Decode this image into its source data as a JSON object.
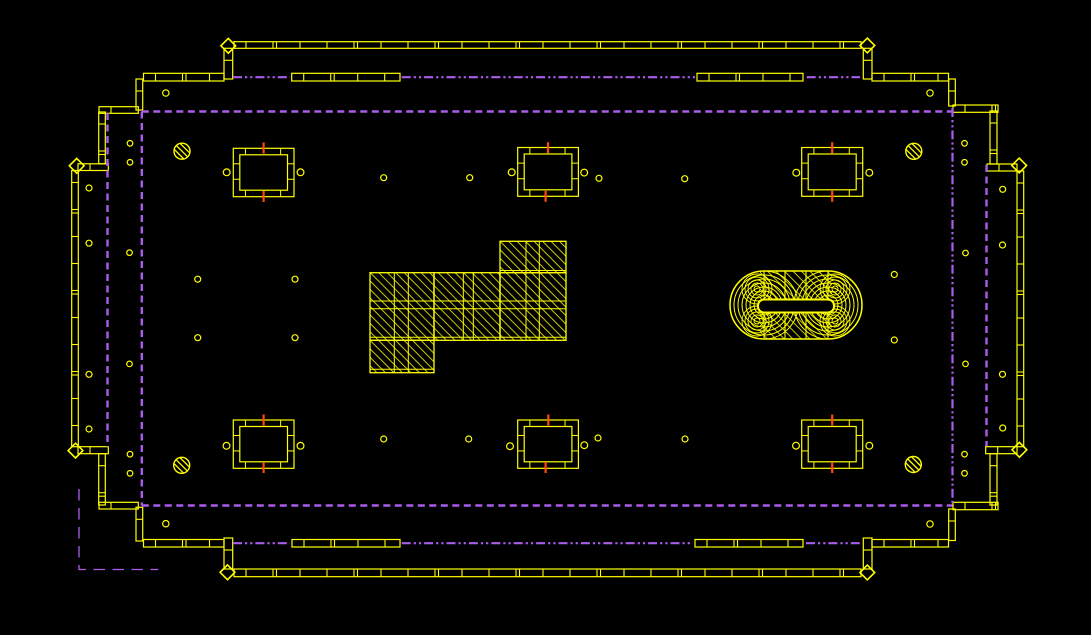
{
  "canvas": {
    "width": 1091,
    "height": 635,
    "background": "#000000"
  },
  "drawing_type": "cad-foundation-floor-plan",
  "colors": {
    "wall": "#ffff00",
    "boundary": "#aa5cec",
    "marker": "#ff4a00",
    "background": "#000000"
  },
  "line_styles": {
    "dash": {
      "width": 2.4,
      "dasharray": [
        7,
        4.5
      ]
    },
    "dashdot": {
      "width": 2.2,
      "dasharray": [
        9,
        3,
        2.2,
        3,
        2.2,
        3
      ]
    },
    "longdash": {
      "width": 1.3,
      "dasharray": [
        11.5,
        7.5
      ]
    }
  },
  "walls": [
    {
      "n": "top-outer-wall",
      "r": [
        234,
        41.7,
        627,
        6.6
      ]
    },
    {
      "n": "top-inner-wall-left",
      "r": [
        143.5,
        73.3,
        80.5,
        7.7
      ]
    },
    {
      "n": "top-inner-wall-mid1",
      "r": [
        291.7,
        73.3,
        108.3,
        7.7
      ]
    },
    {
      "n": "top-inner-wall-mid2",
      "r": [
        697,
        73.3,
        106,
        7.7
      ]
    },
    {
      "n": "top-inner-wall-right",
      "r": [
        872,
        73.3,
        76.5,
        7.7
      ]
    },
    {
      "n": "step-wall-top-left",
      "r": [
        99,
        106.7,
        39.3,
        6.6
      ]
    },
    {
      "n": "step-wall-top-right",
      "r": [
        953,
        105,
        45,
        7.3
      ]
    },
    {
      "n": "cap-wall-top-left",
      "r": [
        78,
        163.8,
        30.3,
        6.7
      ]
    },
    {
      "n": "cap-wall-top-right",
      "r": [
        987,
        164,
        30,
        7
      ]
    },
    {
      "n": "cap-wall-bottom-left",
      "r": [
        78,
        446.7,
        30.3,
        7
      ]
    },
    {
      "n": "cap-wall-bottom-right",
      "r": [
        985.7,
        446.7,
        31.3,
        7
      ]
    },
    {
      "n": "step-wall-bottom-left",
      "r": [
        99,
        502.3,
        39.3,
        6.7
      ]
    },
    {
      "n": "step-wall-bottom-right",
      "r": [
        953,
        502.3,
        45,
        7.4
      ]
    },
    {
      "n": "bottom-inner-wall-left",
      "r": [
        143.5,
        539.5,
        80.5,
        7.5
      ]
    },
    {
      "n": "bottom-inner-wall-mid1",
      "r": [
        292,
        539.5,
        108,
        7.5
      ]
    },
    {
      "n": "bottom-inner-wall-mid2",
      "r": [
        695,
        539.5,
        108,
        7.5
      ]
    },
    {
      "n": "bottom-inner-wall-right",
      "r": [
        872,
        539.5,
        76.5,
        7.5
      ]
    },
    {
      "n": "bottom-outer-wall",
      "r": [
        234,
        569,
        627,
        7.7
      ]
    },
    {
      "n": "connector-top-left",
      "r": [
        224,
        48.3,
        8.7,
        30.7
      ]
    },
    {
      "n": "connector-top-right",
      "r": [
        863.3,
        48.3,
        8.7,
        30.7
      ]
    },
    {
      "n": "connector-bottom-left",
      "r": [
        224,
        538,
        8.7,
        31
      ]
    },
    {
      "n": "connector-bottom-right",
      "r": [
        863.3,
        538,
        8.7,
        31
      ]
    },
    {
      "n": "step-v1-top-left",
      "r": [
        136,
        79,
        6.7,
        31
      ]
    },
    {
      "n": "step-v2-top-left",
      "r": [
        98.7,
        112,
        6.6,
        51.8
      ]
    },
    {
      "n": "step-v1-top-right",
      "r": [
        948.7,
        79,
        6.6,
        27
      ]
    },
    {
      "n": "step-v2-top-right",
      "r": [
        990,
        111,
        7,
        53
      ]
    },
    {
      "n": "left-outer-wall",
      "r": [
        71.7,
        170.5,
        6.6,
        276.2
      ]
    },
    {
      "n": "right-outer-wall",
      "r": [
        1017,
        171,
        6.7,
        275.7
      ]
    },
    {
      "n": "step-v1-bottom-left",
      "r": [
        136,
        507.3,
        6.7,
        33.7
      ]
    },
    {
      "n": "step-v2-bottom-left",
      "r": [
        98.7,
        453.7,
        6.6,
        51.3
      ]
    },
    {
      "n": "step-v1-bottom-right",
      "r": [
        948.7,
        509,
        6.6,
        31.5
      ]
    },
    {
      "n": "step-v2-bottom-right",
      "r": [
        990,
        453.7,
        7,
        51.3
      ]
    }
  ],
  "pier_boxes": [
    {
      "n": "pier-top-left",
      "r": [
        233.3,
        148.3,
        60.7,
        48.4
      ]
    },
    {
      "n": "pier-top-middle",
      "r": [
        517.7,
        147.5,
        60.7,
        48.8
      ]
    },
    {
      "n": "pier-top-right",
      "r": [
        801.7,
        147.5,
        61,
        48.8
      ]
    },
    {
      "n": "pier-bottom-left",
      "r": [
        233.3,
        420,
        60.7,
        48.3
      ]
    },
    {
      "n": "pier-bottom-middle",
      "r": [
        517.7,
        420,
        60.7,
        48.3
      ]
    },
    {
      "n": "pier-bottom-right",
      "r": [
        801.7,
        420,
        61,
        48.3
      ]
    }
  ],
  "orange_ticks": [
    [
      263.6,
      148
    ],
    [
      263.6,
      196.5
    ],
    [
      548,
      147.7
    ],
    [
      545.6,
      196.3
    ],
    [
      832.2,
      147.7
    ],
    [
      832.2,
      196.3
    ],
    [
      548.3,
      420
    ],
    [
      545.6,
      467.5
    ],
    [
      263.6,
      420
    ],
    [
      263.6,
      467.5
    ],
    [
      832.2,
      420
    ],
    [
      832.2,
      467.5
    ]
  ],
  "small_circles": [
    [
      226.7,
      172.3,
      3.4
    ],
    [
      300.5,
      172.3,
      3.4
    ],
    [
      511.7,
      172.3,
      3.4
    ],
    [
      584.2,
      172.6,
      3.4
    ],
    [
      796.3,
      172.7,
      3.4
    ],
    [
      869.3,
      172.7,
      3.4
    ],
    [
      226.5,
      445.8,
      3.4
    ],
    [
      300.5,
      445.8,
      3.4
    ],
    [
      510,
      446.2,
      3.4
    ],
    [
      584.3,
      445.2,
      3.4
    ],
    [
      796,
      445.7,
      3.4
    ],
    [
      869.3,
      445.7,
      3.4
    ],
    [
      383.7,
      177.7,
      3
    ],
    [
      469.7,
      177.7,
      3
    ],
    [
      599,
      178.3,
      3
    ],
    [
      684.7,
      178.7,
      3
    ],
    [
      383.7,
      439,
      3
    ],
    [
      468.7,
      439,
      3
    ],
    [
      598,
      438,
      3
    ],
    [
      685,
      439,
      3
    ],
    [
      165.8,
      93,
      3.2
    ],
    [
      930,
      93,
      3.2
    ],
    [
      165.8,
      523.7,
      3.2
    ],
    [
      930,
      524,
      3.2
    ],
    [
      130,
      143.3,
      2.8
    ],
    [
      130,
      162.3,
      2.8
    ],
    [
      89,
      188,
      3
    ],
    [
      89,
      243.2,
      3
    ],
    [
      129.5,
      252.7,
      2.8
    ],
    [
      197.7,
      279.2,
      3
    ],
    [
      295,
      279.2,
      3
    ],
    [
      197.7,
      337.7,
      3
    ],
    [
      295,
      337.7,
      3
    ],
    [
      129.5,
      363.9,
      2.8
    ],
    [
      89,
      374.3,
      3
    ],
    [
      89,
      429,
      3
    ],
    [
      130,
      454.2,
      2.8
    ],
    [
      130,
      473.3,
      2.8
    ],
    [
      964.5,
      143.3,
      2.8
    ],
    [
      964.5,
      162.3,
      2.8
    ],
    [
      1002.7,
      189.3,
      3
    ],
    [
      1002.5,
      245,
      3
    ],
    [
      965.5,
      253,
      2.8
    ],
    [
      894.3,
      274.5,
      3
    ],
    [
      894.3,
      340,
      3
    ],
    [
      965.5,
      363.9,
      2.8
    ],
    [
      1002.5,
      374.3,
      3
    ],
    [
      1002.7,
      428,
      3
    ],
    [
      964.5,
      454.2,
      2.8
    ],
    [
      964.5,
      473.3,
      2.8
    ]
  ],
  "hatched_circles": [
    [
      182,
      151.2,
      8
    ],
    [
      913.8,
      151.3,
      8
    ],
    [
      181.7,
      465.3,
      8
    ],
    [
      913.3,
      464.5,
      8
    ]
  ],
  "diamond_anchors": [
    [
      228.3,
      45.8
    ],
    [
      867.3,
      45.5
    ],
    [
      227.5,
      572.3
    ],
    [
      867.3,
      572.5
    ],
    [
      76.7,
      165.8
    ],
    [
      75.5,
      450.6
    ],
    [
      1019.2,
      165.5
    ],
    [
      1019.4,
      449.8
    ]
  ],
  "purple_lines": [
    {
      "n": "boundary-top",
      "style": "dash",
      "pts": [
        [
          141.8,
          111.5
        ],
        [
          952.5,
          111.5
        ]
      ]
    },
    {
      "n": "boundary-left",
      "style": "dash",
      "pts": [
        [
          141.8,
          111.5
        ],
        [
          141.8,
          505.5
        ]
      ]
    },
    {
      "n": "boundary-bottom",
      "style": "dash",
      "pts": [
        [
          141.8,
          505.5
        ],
        [
          952.5,
          505.5
        ]
      ]
    },
    {
      "n": "boundary-right",
      "style": "dashdot",
      "pts": [
        [
          952.5,
          108
        ],
        [
          952.5,
          505.5
        ]
      ]
    },
    {
      "n": "inner-dashed-left",
      "style": "dash",
      "pts": [
        [
          107.5,
          113
        ],
        [
          107.5,
          447
        ]
      ]
    },
    {
      "n": "inner-dashed-right",
      "style": "dash",
      "pts": [
        [
          986.5,
          165
        ],
        [
          986.5,
          446
        ]
      ]
    },
    {
      "n": "axis-top-1",
      "style": "dashdot",
      "pts": [
        [
          233,
          77.2
        ],
        [
          290,
          77.2
        ]
      ]
    },
    {
      "n": "axis-top-2",
      "style": "dashdot",
      "pts": [
        [
          401.7,
          77.2
        ],
        [
          695,
          77.2
        ]
      ]
    },
    {
      "n": "axis-top-3",
      "style": "dashdot",
      "pts": [
        [
          806.7,
          77.2
        ],
        [
          860,
          77.2
        ]
      ]
    },
    {
      "n": "axis-bottom-1",
      "style": "dashdot",
      "pts": [
        [
          233,
          543.2
        ],
        [
          290,
          543.2
        ]
      ]
    },
    {
      "n": "axis-bottom-2",
      "style": "dashdot",
      "pts": [
        [
          401.7,
          543.2
        ],
        [
          693,
          543.2
        ]
      ]
    },
    {
      "n": "axis-bottom-3",
      "style": "dashdot",
      "pts": [
        [
          806,
          543.2
        ],
        [
          861.7,
          543.2
        ]
      ]
    },
    {
      "n": "setback-corner",
      "style": "longdash",
      "pts": [
        [
          79,
          489
        ],
        [
          79,
          569.5
        ],
        [
          158.3,
          569.5
        ]
      ]
    }
  ],
  "hatch_region": {
    "blocks": [
      [
        500,
        241.3,
        66,
        31.4
      ],
      [
        370,
        272.7,
        64,
        67.6
      ],
      [
        434,
        272.7,
        66,
        67.6
      ],
      [
        500,
        272.7,
        66,
        67.6
      ],
      [
        370,
        340.3,
        64,
        32.4
      ]
    ],
    "ribs_v": [
      [
        394.3,
        272.7,
        372.7
      ],
      [
        408.3,
        272.7,
        372.7
      ],
      [
        463.3,
        272.7,
        340.3
      ],
      [
        473.3,
        272.7,
        340.3
      ],
      [
        526,
        241.3,
        340.3
      ],
      [
        539.3,
        241.3,
        340.3
      ]
    ],
    "ribs_h": [
      [
        301,
        370,
        566
      ],
      [
        308.7,
        370,
        566
      ],
      [
        270.5,
        500,
        566
      ],
      [
        337.3,
        370,
        566
      ],
      [
        369.3,
        370,
        434
      ]
    ]
  },
  "stadium": {
    "x": 730,
    "y": 271,
    "w": 132,
    "h": 68,
    "radius": 34,
    "hatch_rect": [
      760,
      271,
      72,
      68
    ],
    "grid_x": [
      764,
      785,
      806,
      828
    ],
    "grid_y": [
      300,
      312.5
    ],
    "slot": [
      758,
      299.5,
      76,
      13
    ],
    "ring_centers": [
      [
        764,
        305
      ],
      [
        828,
        305
      ]
    ],
    "ring_radii": [
      6,
      10,
      14,
      18,
      22,
      26,
      30,
      34
    ],
    "eye_centers": [
      [
        757,
        289
      ],
      [
        757,
        321
      ],
      [
        835,
        289
      ],
      [
        835,
        321
      ]
    ],
    "eye_radii": [
      3,
      6,
      9,
      12,
      15
    ]
  }
}
